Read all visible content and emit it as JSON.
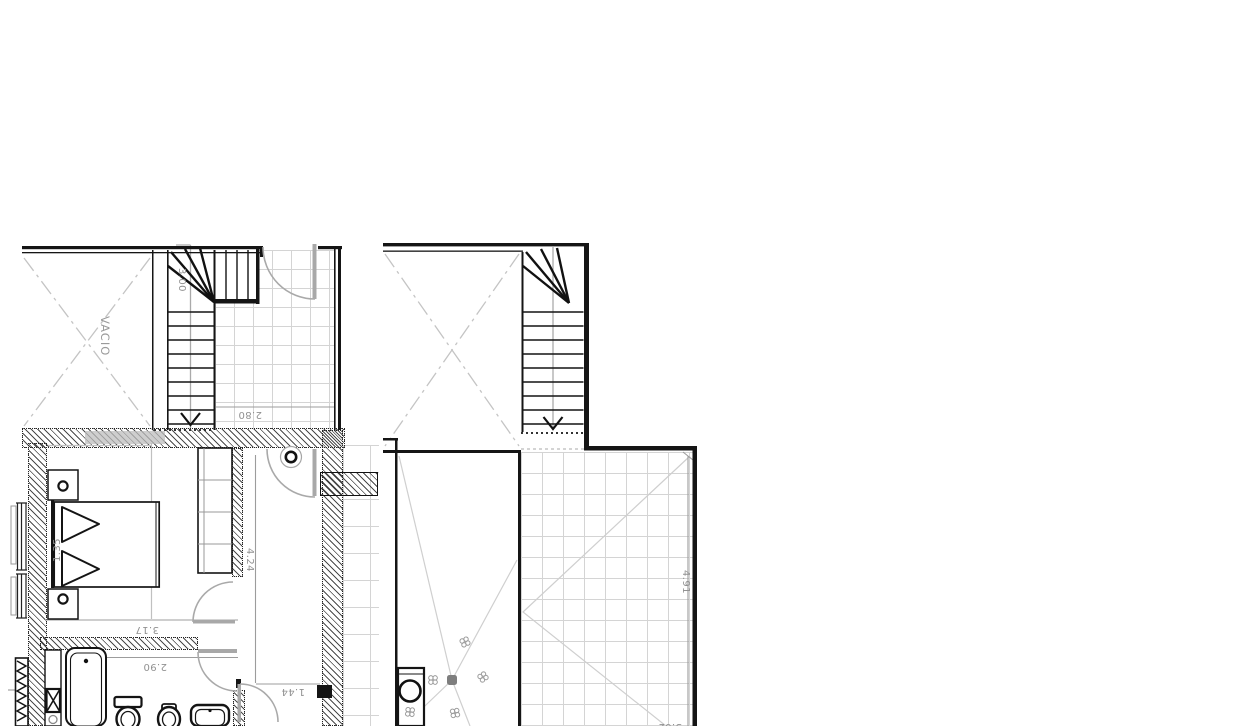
{
  "drawing": {
    "type": "architectural-floor-plan",
    "left_plan": {
      "void_label": "VACIO",
      "stair_length_dim": "3.00",
      "laundry_width_dim": "2.80",
      "bed_width_dim": "1.35",
      "bedroom_width_dim": "3.17",
      "bathroom_width_dim": "2.90",
      "hall_width_dim": "1.44",
      "bedroom_depth_dim": "4.24"
    },
    "right_plan": {
      "terrace_depth_dim": "4.91",
      "terrace_width_dim": "3.62"
    },
    "colors": {
      "wall_line": "#151515",
      "dim_text": "#919191",
      "tile_line": "#d4d4d4",
      "door_swing": "#a8a8a8",
      "slope_line": "#cfcfcf"
    }
  }
}
